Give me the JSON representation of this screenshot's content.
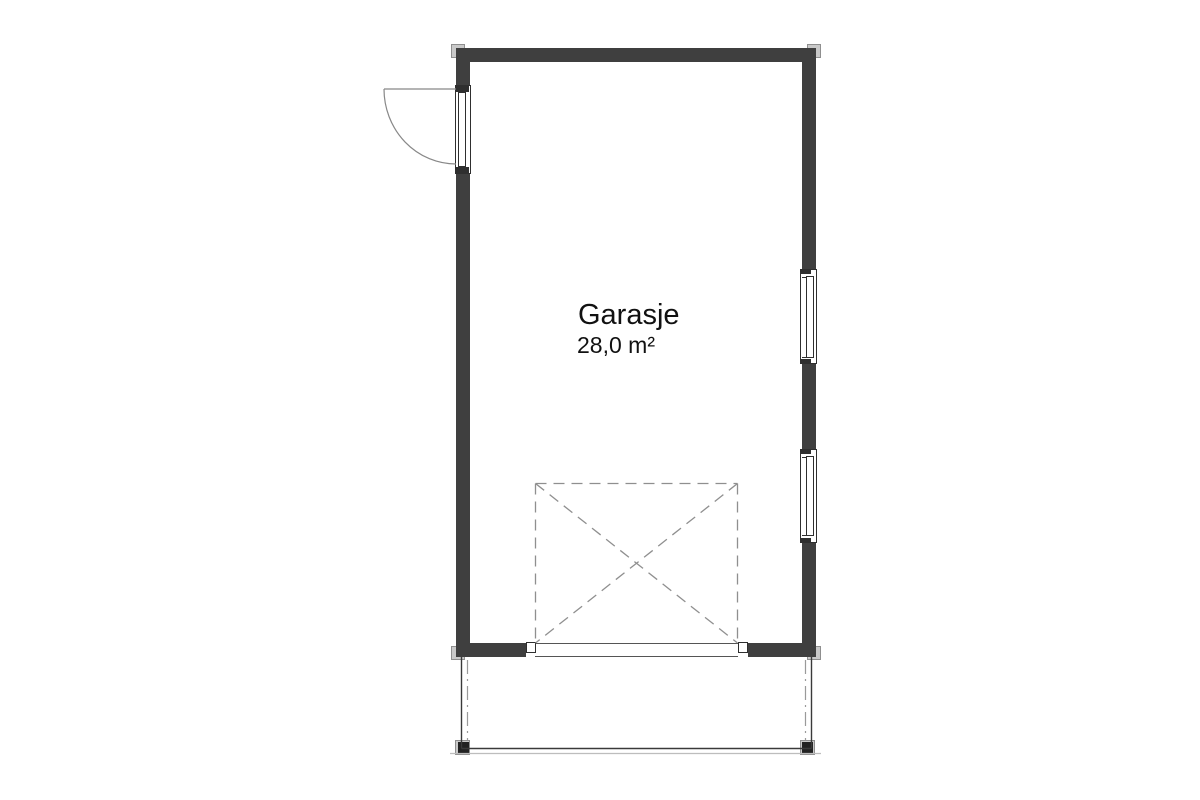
{
  "room": {
    "name": "Garasje",
    "area_label": "28,0 m²"
  },
  "colors": {
    "background": "#ffffff",
    "wall": "#3f3f3f",
    "cap_fill": "#c9c9c9",
    "cap_border": "#8f8f8f",
    "line_dark": "#2f2f2f",
    "line_mid": "#555555",
    "dashed": "#8f8f8f",
    "dashdot": "#9a9a9a",
    "light_edge": "#bdbdbd",
    "text": "#111111"
  }
}
